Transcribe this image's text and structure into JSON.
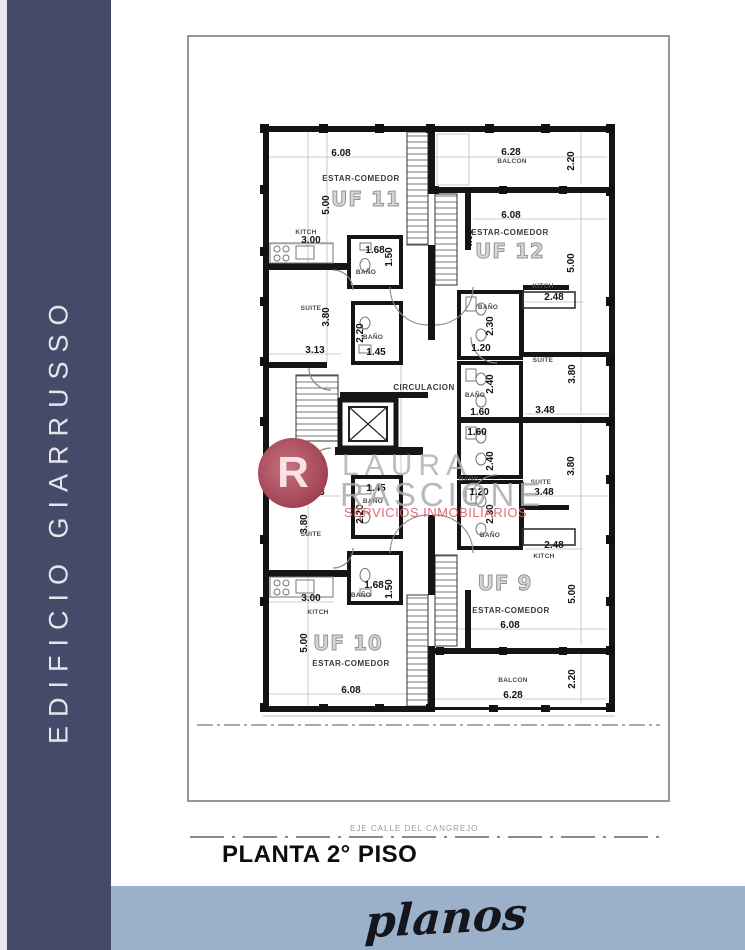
{
  "sidebar": {
    "building_name": "EDIFICIO GIARRUSSO",
    "bg_color": "#434b69",
    "text_color": "#e4e4ea"
  },
  "watermark": {
    "logo_letter": "R",
    "line1": "LAURA",
    "line2": "RASCIONE",
    "line3": "SERVICIOS INMOBILIARIOS",
    "logo_color": "#9c3247",
    "accent_color": "#d3606b"
  },
  "footer": {
    "axis_label": "EJE CALLE DEL CANGREJO",
    "title": "PLANTA 2° PISO"
  },
  "banner": {
    "label": "planos",
    "bg_color": "#9bb0c9"
  },
  "plan": {
    "units": [
      "UF 9",
      "UF 10",
      "UF 11",
      "UF 12"
    ],
    "labels": [
      {
        "t": "6.08",
        "x": 152,
        "y": 117,
        "k": "dim"
      },
      {
        "t": "ESTAR-COMEDOR",
        "x": 172,
        "y": 142,
        "k": "room"
      },
      {
        "t": "UF 11",
        "x": 177,
        "y": 162,
        "k": "unit"
      },
      {
        "t": "5.00",
        "x": 138,
        "y": 168,
        "k": "dimv"
      },
      {
        "t": "KITCH",
        "x": 117,
        "y": 196,
        "k": "small"
      },
      {
        "t": "3.00",
        "x": 122,
        "y": 204,
        "k": "dim"
      },
      {
        "t": "1.68",
        "x": 186,
        "y": 214,
        "k": "dim"
      },
      {
        "t": "1.50",
        "x": 201,
        "y": 220,
        "k": "dimv"
      },
      {
        "t": "BAÑO",
        "x": 177,
        "y": 236,
        "k": "small"
      },
      {
        "t": "SUITE",
        "x": 122,
        "y": 272,
        "k": "small"
      },
      {
        "t": "3.80",
        "x": 138,
        "y": 280,
        "k": "dimv"
      },
      {
        "t": "2.20",
        "x": 172,
        "y": 296,
        "k": "dimv"
      },
      {
        "t": "BAÑO",
        "x": 184,
        "y": 301,
        "k": "small"
      },
      {
        "t": "1.45",
        "x": 187,
        "y": 316,
        "k": "dim"
      },
      {
        "t": "3.13",
        "x": 126,
        "y": 314,
        "k": "dim"
      },
      {
        "t": "6.28",
        "x": 322,
        "y": 116,
        "k": "dim"
      },
      {
        "t": "BALCON",
        "x": 323,
        "y": 125,
        "k": "small"
      },
      {
        "t": "2.20",
        "x": 383,
        "y": 124,
        "k": "dimv"
      },
      {
        "t": "6.08",
        "x": 322,
        "y": 179,
        "k": "dim"
      },
      {
        "t": "ESTAR-COMEDOR",
        "x": 321,
        "y": 196,
        "k": "room"
      },
      {
        "t": "UF 12",
        "x": 321,
        "y": 214,
        "k": "unit"
      },
      {
        "t": "4.00",
        "x": 281,
        "y": 202,
        "k": "dimv"
      },
      {
        "t": "5.00",
        "x": 383,
        "y": 226,
        "k": "dimv"
      },
      {
        "t": "KITCH",
        "x": 354,
        "y": 250,
        "k": "small"
      },
      {
        "t": "2.48",
        "x": 365,
        "y": 261,
        "k": "dim"
      },
      {
        "t": "BAÑO",
        "x": 299,
        "y": 271,
        "k": "small"
      },
      {
        "t": "2.30",
        "x": 302,
        "y": 289,
        "k": "dimv"
      },
      {
        "t": "1.20",
        "x": 292,
        "y": 312,
        "k": "dim"
      },
      {
        "t": "SUITE",
        "x": 354,
        "y": 324,
        "k": "small"
      },
      {
        "t": "3.80",
        "x": 384,
        "y": 337,
        "k": "dimv"
      },
      {
        "t": "2.40",
        "x": 302,
        "y": 347,
        "k": "dimv"
      },
      {
        "t": "BAÑO",
        "x": 286,
        "y": 359,
        "k": "small"
      },
      {
        "t": "1.60",
        "x": 291,
        "y": 376,
        "k": "dim"
      },
      {
        "t": "3.48",
        "x": 356,
        "y": 374,
        "k": "dim"
      },
      {
        "t": "CIRCULACION",
        "x": 235,
        "y": 351,
        "k": "room"
      },
      {
        "t": "1.60",
        "x": 288,
        "y": 396,
        "k": "dim"
      },
      {
        "t": "2.40",
        "x": 302,
        "y": 424,
        "k": "dimv"
      },
      {
        "t": "BAÑO",
        "x": 280,
        "y": 443,
        "k": "small"
      },
      {
        "t": "1.20",
        "x": 290,
        "y": 456,
        "k": "dim"
      },
      {
        "t": "3.80",
        "x": 383,
        "y": 429,
        "k": "dimv"
      },
      {
        "t": "SUITE",
        "x": 352,
        "y": 446,
        "k": "small"
      },
      {
        "t": "3.48",
        "x": 355,
        "y": 456,
        "k": "dim"
      },
      {
        "t": "2.30",
        "x": 302,
        "y": 477,
        "k": "dimv"
      },
      {
        "t": "BAÑO",
        "x": 301,
        "y": 499,
        "k": "small"
      },
      {
        "t": "2.48",
        "x": 365,
        "y": 509,
        "k": "dim"
      },
      {
        "t": "KITCH",
        "x": 355,
        "y": 520,
        "k": "small"
      },
      {
        "t": "UF 9",
        "x": 316,
        "y": 546,
        "k": "unit"
      },
      {
        "t": "ESTAR-COMEDOR",
        "x": 322,
        "y": 574,
        "k": "room"
      },
      {
        "t": "6.08",
        "x": 321,
        "y": 589,
        "k": "dim"
      },
      {
        "t": "5.00",
        "x": 384,
        "y": 557,
        "k": "dimv"
      },
      {
        "t": "BALCON",
        "x": 324,
        "y": 644,
        "k": "small"
      },
      {
        "t": "6.28",
        "x": 324,
        "y": 659,
        "k": "dim"
      },
      {
        "t": "2.20",
        "x": 384,
        "y": 642,
        "k": "dimv"
      },
      {
        "t": "3.13",
        "x": 126,
        "y": 456,
        "k": "dim"
      },
      {
        "t": "1.45",
        "x": 187,
        "y": 452,
        "k": "dim"
      },
      {
        "t": "BAÑO",
        "x": 184,
        "y": 465,
        "k": "small"
      },
      {
        "t": "2.20",
        "x": 172,
        "y": 477,
        "k": "dimv"
      },
      {
        "t": "SUITE",
        "x": 122,
        "y": 498,
        "k": "small"
      },
      {
        "t": "3.80",
        "x": 116,
        "y": 487,
        "k": "dimv"
      },
      {
        "t": "1.68",
        "x": 185,
        "y": 549,
        "k": "dim"
      },
      {
        "t": "1.50",
        "x": 201,
        "y": 552,
        "k": "dimv"
      },
      {
        "t": "BAÑO",
        "x": 172,
        "y": 559,
        "k": "small"
      },
      {
        "t": "3.00",
        "x": 122,
        "y": 562,
        "k": "dim"
      },
      {
        "t": "KITCH",
        "x": 129,
        "y": 576,
        "k": "small"
      },
      {
        "t": "5.00",
        "x": 116,
        "y": 606,
        "k": "dimv"
      },
      {
        "t": "UF 10",
        "x": 159,
        "y": 606,
        "k": "unit"
      },
      {
        "t": "ESTAR-COMEDOR",
        "x": 162,
        "y": 627,
        "k": "room"
      },
      {
        "t": "6.08",
        "x": 162,
        "y": 654,
        "k": "dim"
      }
    ]
  }
}
